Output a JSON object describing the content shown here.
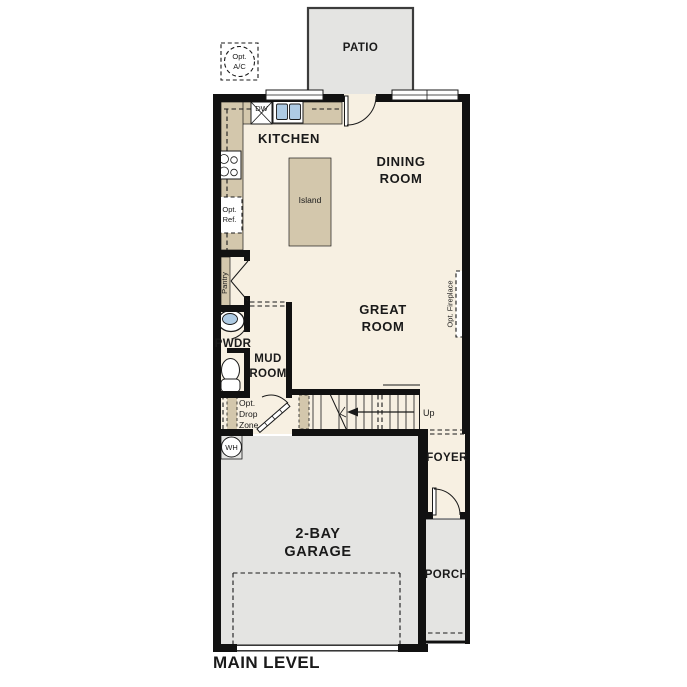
{
  "plan_title": "MAIN LEVEL",
  "rooms": {
    "patio": "PATIO",
    "kitchen": "KITCHEN",
    "dining_line1": "DINING",
    "dining_line2": "ROOM",
    "great_line1": "GREAT",
    "great_line2": "ROOM",
    "powder": "PWDR",
    "mud_line1": "MUD",
    "mud_line2": "ROOM",
    "foyer": "FOYER",
    "garage_line1": "2-BAY",
    "garage_line2": "GARAGE",
    "porch": "PORCH"
  },
  "fixtures": {
    "island": "Island",
    "dishwasher": "DW",
    "water_heater": "WH",
    "pantry": "Pantry",
    "stairs_up": "Up"
  },
  "options": {
    "ac_line1": "Opt.",
    "ac_line2": "A/C",
    "ref_line1": "Opt.",
    "ref_line2": "Ref.",
    "fireplace": "Opt. Fireplace",
    "drop_line1": "Opt.",
    "drop_line2": "Drop",
    "drop_line3": "Zone"
  },
  "colors": {
    "wall": "#111111",
    "floor": "#f7f0e2",
    "hardscape": "#e4e4e2",
    "cabinet": "#d3c7ac",
    "water": "#aecbe4",
    "ink": "#1a1a1a"
  }
}
